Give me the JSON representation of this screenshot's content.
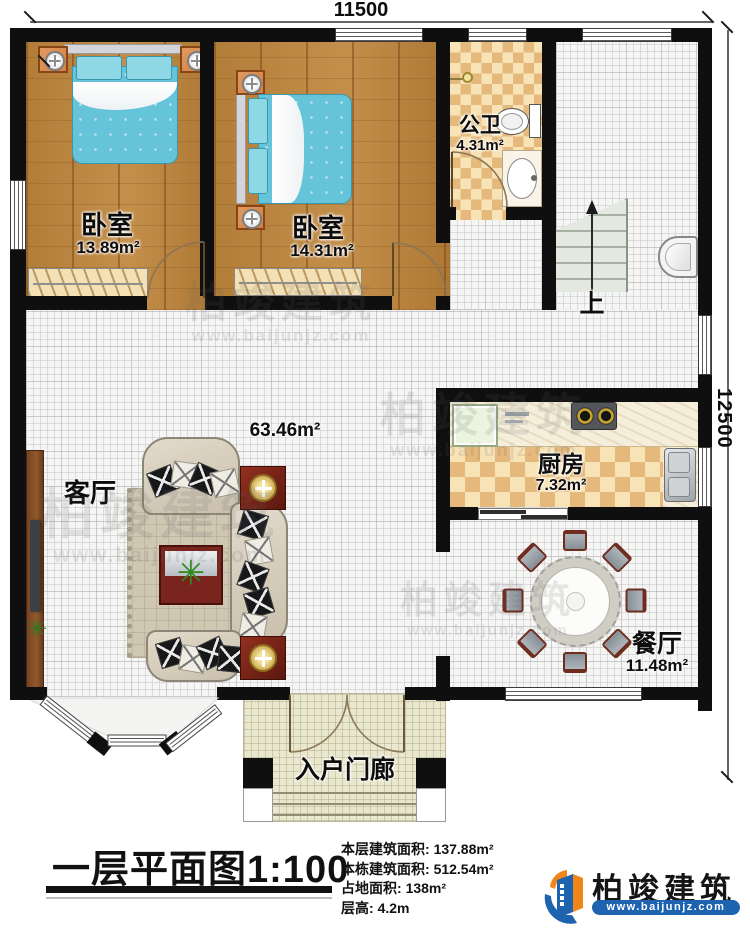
{
  "dimensions": {
    "top": "11500",
    "right": "12500"
  },
  "rooms": {
    "bedroom1": {
      "name": "卧室",
      "area": "13.89m²"
    },
    "bedroom2": {
      "name": "卧室",
      "area": "14.31m²"
    },
    "bathroom": {
      "name": "公卫",
      "area": "4.31m²"
    },
    "kitchen": {
      "name": "厨房",
      "area": "7.32m²"
    },
    "living": {
      "name": "客厅",
      "area": "63.46m²"
    },
    "dining": {
      "name": "餐厅",
      "area": "11.48m²"
    },
    "porch": {
      "name": "入户门廊"
    },
    "stairs": {
      "up_label": "上"
    }
  },
  "title": {
    "text": "一层平面图",
    "scale": "1:100"
  },
  "info": {
    "lines": [
      {
        "label": "本层建筑面积:",
        "value": "137.88m²"
      },
      {
        "label": "本栋建筑面积:",
        "value": "512.54m²"
      },
      {
        "label": "占地面积:",
        "value": "138m²"
      },
      {
        "label": "层高:",
        "value": "4.2m"
      }
    ]
  },
  "logo": {
    "name": "柏竣建筑",
    "url": "www.baijunjz.com"
  },
  "watermark": {
    "name": "柏竣建筑",
    "url": "www.baijunjz.com"
  },
  "colors": {
    "wall": "#0f0f0f",
    "wood": "#b5813c",
    "bed": "#6cc6da",
    "checker": "#e5b97c",
    "stair": "#dfe5dc",
    "logo_blue": "#1e63b0",
    "logo_orange": "#f08519"
  }
}
